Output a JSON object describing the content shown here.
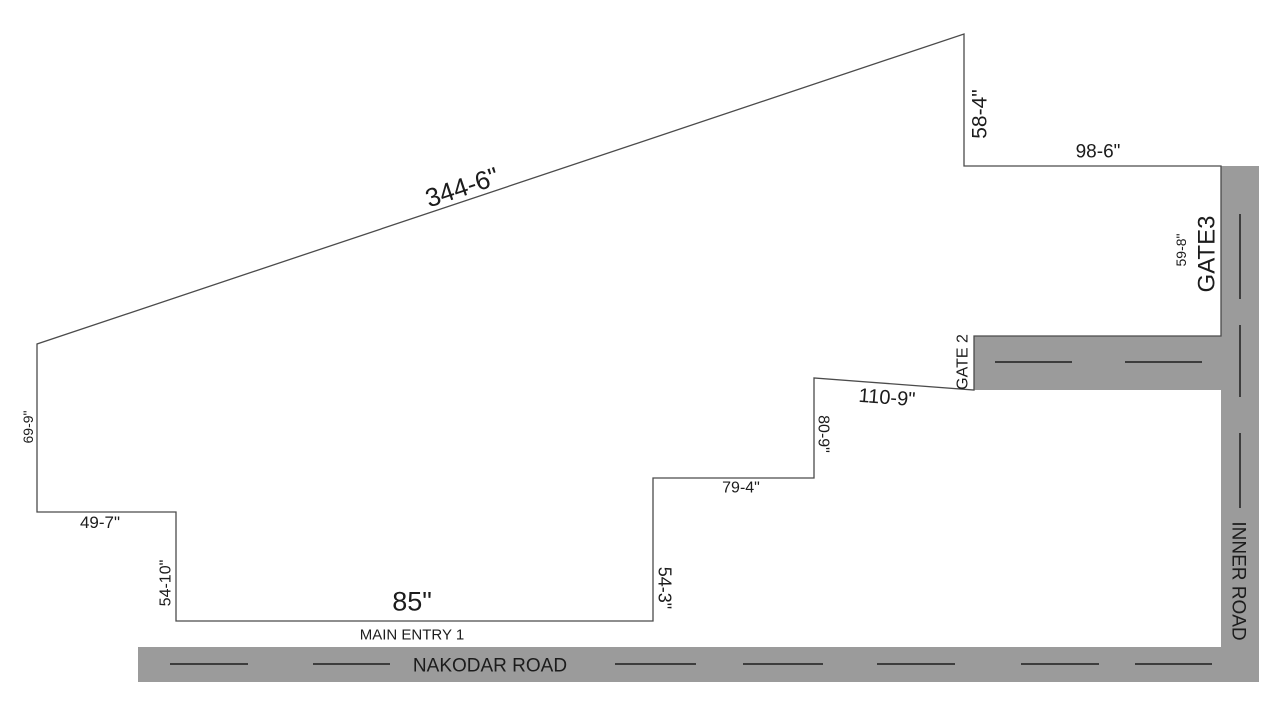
{
  "plan": {
    "colors": {
      "background": "#ffffff",
      "road_fill": "#9b9b9b",
      "boundary_line": "#4b4b4b",
      "lane_marking": "#3d3d3d",
      "label_text": "#1c1c1c"
    },
    "boundary": {
      "name": "property-boundary",
      "points": [
        [
          964,
          34
        ],
        [
          964,
          166
        ],
        [
          1221,
          166
        ],
        [
          1221,
          336
        ],
        [
          974,
          336
        ],
        [
          974,
          390
        ],
        [
          814,
          378
        ],
        [
          814,
          478
        ],
        [
          653,
          478
        ],
        [
          653,
          621
        ],
        [
          176,
          621
        ],
        [
          176,
          512
        ],
        [
          37,
          512
        ],
        [
          37,
          344
        ]
      ]
    },
    "roads": [
      {
        "name": "nakodar-road",
        "label": "NAKODAR ROAD",
        "x": 138,
        "y": 647,
        "width": 1121,
        "height": 35
      },
      {
        "name": "inner-road",
        "label": "INNER ROAD",
        "x": 1221,
        "y": 166,
        "width": 38,
        "height": 516
      },
      {
        "name": "gate2-access-road",
        "label": "GATE 2",
        "x": 974,
        "y": 336,
        "width": 247,
        "height": 54
      }
    ],
    "lane_markings": [
      {
        "road": "nakodar-road",
        "x1": 170,
        "y1": 664,
        "x2": 248,
        "y2": 664
      },
      {
        "road": "nakodar-road",
        "x1": 313,
        "y1": 664,
        "x2": 390,
        "y2": 664
      },
      {
        "road": "nakodar-road",
        "x1": 615,
        "y1": 664,
        "x2": 696,
        "y2": 664
      },
      {
        "road": "nakodar-road",
        "x1": 743,
        "y1": 664,
        "x2": 823,
        "y2": 664
      },
      {
        "road": "nakodar-road",
        "x1": 877,
        "y1": 664,
        "x2": 955,
        "y2": 664
      },
      {
        "road": "nakodar-road",
        "x1": 1021,
        "y1": 664,
        "x2": 1099,
        "y2": 664
      },
      {
        "road": "nakodar-road",
        "x1": 1135,
        "y1": 664,
        "x2": 1212,
        "y2": 664
      },
      {
        "road": "inner-road",
        "x1": 1240,
        "y1": 214,
        "x2": 1240,
        "y2": 299
      },
      {
        "road": "inner-road",
        "x1": 1240,
        "y1": 325,
        "x2": 1240,
        "y2": 397
      },
      {
        "road": "inner-road",
        "x1": 1240,
        "y1": 433,
        "x2": 1240,
        "y2": 508
      },
      {
        "road": "gate2-access-road",
        "x1": 995,
        "y1": 362,
        "x2": 1072,
        "y2": 362
      },
      {
        "road": "gate2-access-road",
        "x1": 1125,
        "y1": 362,
        "x2": 1202,
        "y2": 362
      }
    ],
    "labels": [
      {
        "name": "dim-label-344-6",
        "text": "344-6\"",
        "x": 462,
        "y": 187,
        "rotate": -18.5,
        "size": 26
      },
      {
        "name": "dim-label-58-4",
        "text": "58-4\"",
        "x": 979,
        "y": 114,
        "rotate": -90,
        "size": 21
      },
      {
        "name": "dim-label-98-6",
        "text": "98-6\"",
        "x": 1098,
        "y": 151,
        "rotate": 0,
        "size": 19
      },
      {
        "name": "dim-label-59-8",
        "text": "59-8\"",
        "x": 1181,
        "y": 250,
        "rotate": -90,
        "size": 14
      },
      {
        "name": "gate3-label",
        "text": "GATE3",
        "x": 1206,
        "y": 254,
        "rotate": -90,
        "size": 24
      },
      {
        "name": "gate2-label",
        "text": "GATE 2",
        "x": 962,
        "y": 362,
        "rotate": -90,
        "size": 16
      },
      {
        "name": "dim-label-110-9",
        "text": "110-9\"",
        "x": 887,
        "y": 397,
        "rotate": 4.5,
        "size": 20
      },
      {
        "name": "dim-label-80-9",
        "text": "80-9\"",
        "x": 824,
        "y": 434,
        "rotate": 90,
        "size": 16
      },
      {
        "name": "dim-label-79-4",
        "text": "79-4\"",
        "x": 741,
        "y": 487,
        "rotate": 0,
        "size": 16
      },
      {
        "name": "dim-label-54-3",
        "text": "54-3\"",
        "x": 665,
        "y": 588,
        "rotate": 90,
        "size": 18
      },
      {
        "name": "dim-label-85",
        "text": "85\"",
        "x": 412,
        "y": 601,
        "rotate": 0,
        "size": 27
      },
      {
        "name": "main-entry1-label",
        "text": "MAIN ENTRY 1",
        "x": 412,
        "y": 634,
        "rotate": 0,
        "size": 15
      },
      {
        "name": "nakodar-road-label",
        "text": "NAKODAR ROAD",
        "x": 490,
        "y": 665,
        "rotate": 0,
        "size": 19
      },
      {
        "name": "inner-road-label",
        "text": "INNER ROAD",
        "x": 1239,
        "y": 581,
        "rotate": 90,
        "size": 19
      },
      {
        "name": "dim-label-69-9",
        "text": "69-9\"",
        "x": 28,
        "y": 427,
        "rotate": -90,
        "size": 14
      },
      {
        "name": "dim-label-54-10",
        "text": "54-10\"",
        "x": 165,
        "y": 583,
        "rotate": -90,
        "size": 16
      },
      {
        "name": "dim-label-49-7",
        "text": "49-7\"",
        "x": 100,
        "y": 522,
        "rotate": 0,
        "size": 17
      }
    ]
  }
}
